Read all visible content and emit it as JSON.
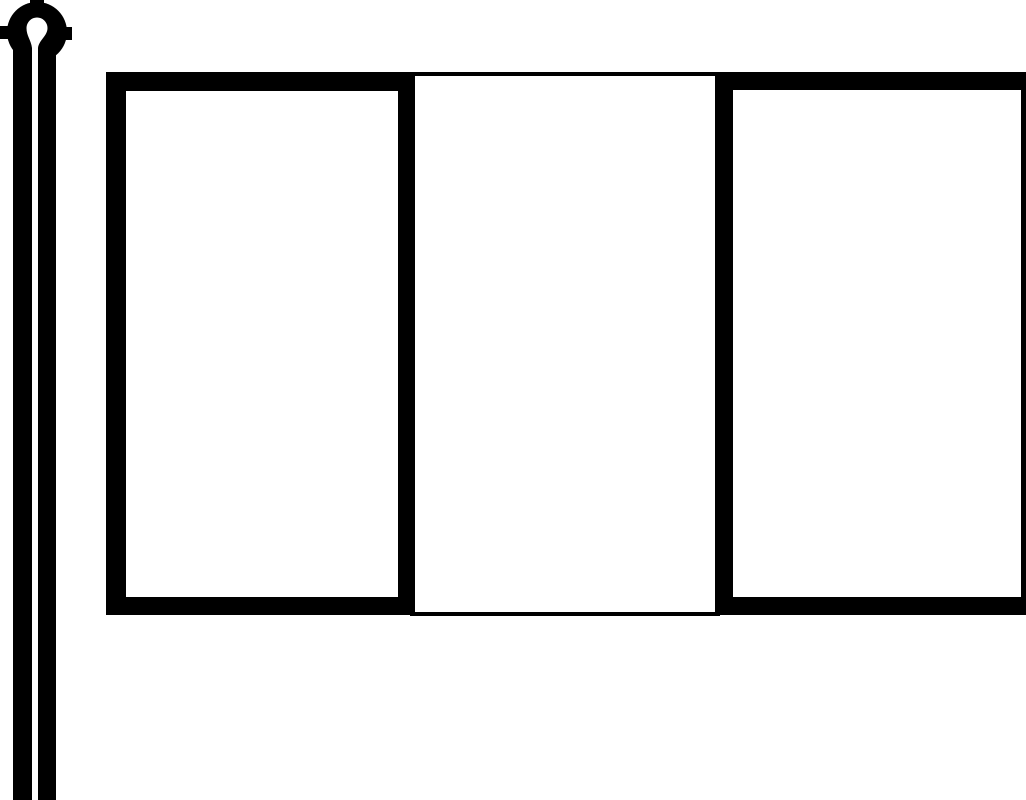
{
  "description": "Black-and-white outline clip art of a blank three-panel flag attached to a flagpole with a needle-eye loop at its top; the pole runs off the bottom edge and the flag runs off the right edge",
  "colors": {
    "background": "#ffffff",
    "ink": "#000000"
  },
  "flag": {
    "panel_count": 3,
    "panels": [
      {
        "name": "left",
        "fill": "#ffffff",
        "outline": "thick"
      },
      {
        "name": "middle",
        "fill": "#ffffff",
        "outline": "thin"
      },
      {
        "name": "right",
        "fill": "#ffffff",
        "outline": "thick"
      }
    ]
  },
  "pole": {
    "finial": "needle-eye loop",
    "line_count": 2
  }
}
